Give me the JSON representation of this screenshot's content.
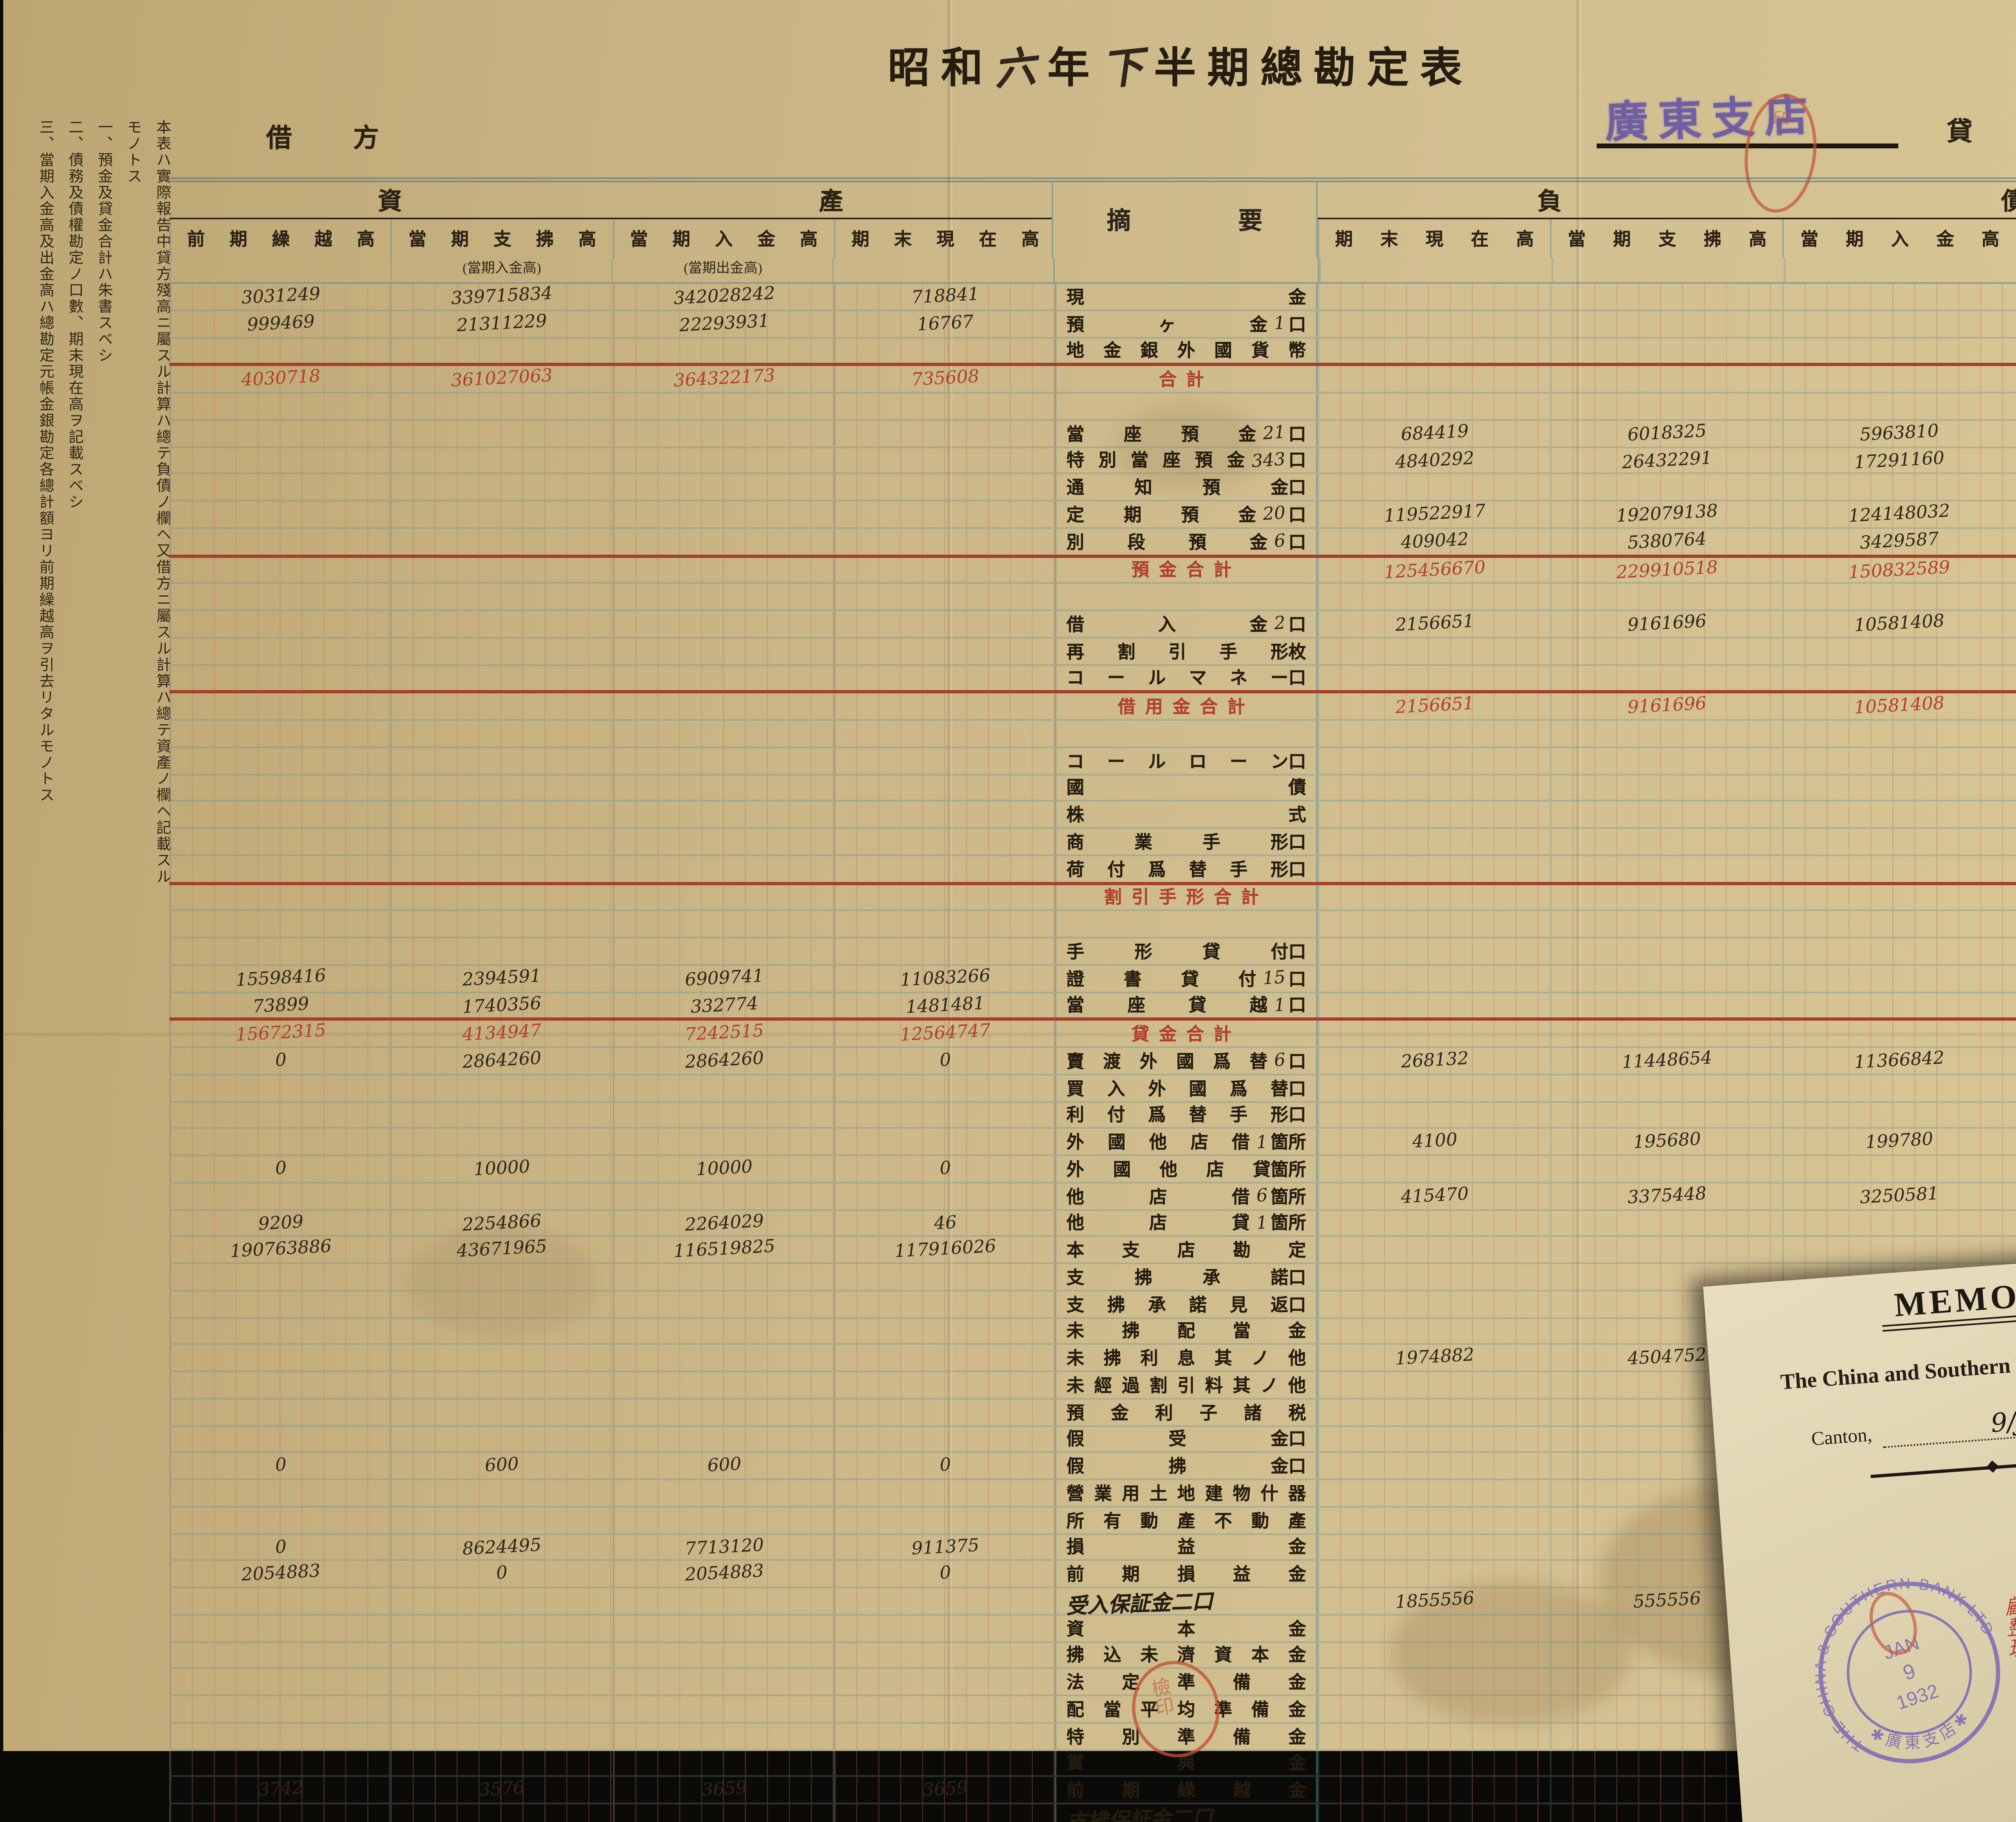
{
  "document": {
    "title": {
      "printed_prefix": "昭和",
      "hand_year": "六",
      "printed_mid": "年",
      "hand_period": "下",
      "printed_suffix": "半期總勘定表"
    },
    "branch_stamp": "廣東支店",
    "debit_header": "借方",
    "credit_header": "貸方",
    "notes": [
      "本表ハ實際報告中貸方殘高ニ屬スル計算ハ總テ負債ノ欄ヘ又借方ニ屬スル計算ハ總テ資產ノ欄ヘ記載スルモノトス",
      "一、預金及貸金合計ハ朱書スベシ",
      "二、債務及債權勘定ノ口數、期末現在高ヲ記載スベシ",
      "三、當期入金高及出金高ハ總勘定元帳金銀勘定各總計額ヨリ前期繰越高ヲ引去リタルモノトス"
    ],
    "table": {
      "left_group": "資產",
      "right_group": "負債",
      "middle_header": "摘要",
      "left_columns": [
        "前期繰越高",
        "當期支拂高",
        "當期入金高",
        "期末現在高"
      ],
      "left_subcolumns": [
        "",
        "(當期入金高)",
        "(當期出金高)",
        ""
      ],
      "right_columns": [
        "期末現在高",
        "當期支拂高",
        "當期入金高",
        "前期繰越高"
      ],
      "rows": [
        {
          "l": "現金",
          "t": "n",
          "L": [
            "3031249",
            "339715834",
            "342028242",
            "718841"
          ]
        },
        {
          "l": "預ヶ金",
          "c": "1",
          "u": "口",
          "t": "n",
          "L": [
            "999469",
            "21311229",
            "22293931",
            "16767"
          ]
        },
        {
          "l": "地金銀外國貨幣",
          "t": "n",
          "rl": true
        },
        {
          "l": "合計",
          "t": "r",
          "L": [
            "4030718",
            "361027063",
            "364322173",
            "735608"
          ]
        },
        {
          "t": "s"
        },
        {
          "l": "當座預金",
          "c": "21",
          "u": "口",
          "t": "n",
          "R": [
            "684419",
            "6018325",
            "5963810",
            "738934"
          ]
        },
        {
          "l": "特別當座預金",
          "c": "343",
          "u": "口",
          "t": "n",
          "R": [
            "4840292",
            "26432291",
            "17291160",
            "13981423"
          ]
        },
        {
          "l": "通知預金",
          "u": "口",
          "t": "n"
        },
        {
          "l": "定期預金",
          "c": "20",
          "u": "口",
          "t": "n",
          "R": [
            "119522917",
            "192079138",
            "124148032",
            "187454023"
          ]
        },
        {
          "l": "別段預金",
          "c": "6",
          "u": "口",
          "t": "n",
          "rl": true,
          "R": [
            "409042",
            "5380764",
            "3429587",
            "2360219"
          ]
        },
        {
          "l": "預金合計",
          "t": "r",
          "R": [
            "125456670",
            "229910518",
            "150832589",
            "204534599"
          ]
        },
        {
          "t": "s"
        },
        {
          "l": "借入金",
          "c": "2",
          "u": "口",
          "t": "n",
          "R": [
            "2156651",
            "9161696",
            "10581408",
            "736939"
          ]
        },
        {
          "l": "再割引手形",
          "u": "枚",
          "t": "n"
        },
        {
          "l": "コールマネー",
          "u": "口",
          "t": "n",
          "rl": true
        },
        {
          "l": "借用金合計",
          "t": "r",
          "R": [
            "2156651",
            "9161696",
            "10581408",
            "736939"
          ]
        },
        {
          "t": "s"
        },
        {
          "l": "コールローン",
          "u": "口",
          "t": "n"
        },
        {
          "l": "國債",
          "t": "n"
        },
        {
          "l": "株式",
          "t": "n"
        },
        {
          "l": "商業手形",
          "u": "口",
          "t": "n"
        },
        {
          "l": "荷付爲替手形",
          "u": "口",
          "t": "n",
          "rl": true
        },
        {
          "l": "割引手形合計",
          "t": "r"
        },
        {
          "t": "s"
        },
        {
          "l": "手形貸付",
          "u": "口",
          "t": "n"
        },
        {
          "l": "證書貸付",
          "c": "15",
          "u": "口",
          "t": "n",
          "L": [
            "15598416",
            "2394591",
            "6909741",
            "11083266"
          ]
        },
        {
          "l": "當座貸越",
          "c": "1",
          "u": "口",
          "t": "n",
          "rl": true,
          "L": [
            "73899",
            "1740356",
            "332774",
            "1481481"
          ]
        },
        {
          "l": "貸金合計",
          "t": "r",
          "L": [
            "15672315",
            "4134947",
            "7242515",
            "12564747"
          ]
        },
        {
          "l": "賣渡外國爲替",
          "c": "6",
          "u": "口",
          "t": "n",
          "L": [
            "0",
            "2864260",
            "2864260",
            "0"
          ],
          "R": [
            "268132",
            "11448654",
            "11366842",
            "349944"
          ]
        },
        {
          "l": "買入外國爲替",
          "u": "口",
          "t": "n"
        },
        {
          "l": "利付爲替手形",
          "u": "口",
          "t": "n"
        },
        {
          "l": "外國他店借",
          "c": "1",
          "u": "箇所",
          "t": "n",
          "R": [
            "4100",
            "195680",
            "199780",
            "0"
          ]
        },
        {
          "l": "外國他店貸",
          "u": "箇所",
          "t": "n",
          "L": [
            "0",
            "10000",
            "10000",
            "0"
          ]
        },
        {
          "l": "他店借",
          "c": "6",
          "u": "箇所",
          "t": "n",
          "R": [
            "415470",
            "3375448",
            "3250581",
            "540337"
          ]
        },
        {
          "l": "他店貸",
          "c": "1",
          "u": "箇所",
          "t": "n",
          "L": [
            "9209",
            "2254866",
            "2264029",
            "46"
          ]
        },
        {
          "l": "本支店勘定",
          "t": "n",
          "L": [
            "190763886",
            "43671965",
            "116519825",
            "117916026"
          ]
        },
        {
          "l": "支拂承諾",
          "u": "口",
          "t": "n"
        },
        {
          "l": "支拂承諾見返",
          "u": "口",
          "t": "n"
        },
        {
          "l": "未拂配當金",
          "t": "n"
        },
        {
          "l": "未拂利息其ノ他",
          "t": "n",
          "R": [
            "1974882",
            "4504752",
            "1974882",
            "4504752"
          ]
        },
        {
          "l": "未經過割引料其ノ他",
          "t": "n"
        },
        {
          "l": "預金利子諸税",
          "t": "n"
        },
        {
          "l": "假受金",
          "u": "口",
          "t": "n"
        },
        {
          "l": "假拂金",
          "u": "口",
          "t": "n",
          "L": [
            "0",
            "600",
            "600",
            "0"
          ]
        },
        {
          "l": "營業用土地建物什器",
          "t": "n"
        },
        {
          "l": "所有動產不動產",
          "t": "n"
        },
        {
          "l": "損益金",
          "t": "n",
          "L": [
            "0",
            "8624495",
            "7713120",
            "911375"
          ]
        },
        {
          "l": "前期損益金",
          "t": "n",
          "L": [
            "2054883",
            "0",
            "2054883",
            "0"
          ]
        },
        {
          "l": "受入保証金二口",
          "t": "h",
          "R": [
            "1855556",
            "555556",
            "",
            ""
          ]
        },
        {
          "l": "資本金",
          "t": "n"
        },
        {
          "l": "拂込未濟資本金",
          "t": "n"
        },
        {
          "l": "法定準備金",
          "t": "n"
        },
        {
          "l": "配當平均準備金",
          "t": "n"
        },
        {
          "l": "特別準備金",
          "t": "n"
        },
        {
          "l": "賞與金",
          "t": "n"
        },
        {
          "l": "前期繰越金",
          "t": "n",
          "L": [
            "3742",
            "3576",
            "3659",
            "3659"
          ]
        },
        {
          "l": "支拂保証金二口",
          "t": "h"
        },
        {
          "l": "總計",
          "t": "t",
          "L": [
            "212534753",
            "422591772",
            "502995064",
            "132131461"
          ],
          "R": [
            "132131461",
            "259152304",
            "",
            ""
          ]
        }
      ]
    },
    "bottom_seal_chars": "檢印",
    "top_seal_chars": "印",
    "memo": {
      "heading": "MEMO.",
      "bank": "The China and Southern Bank, Limited.",
      "place": "Canton,",
      "date_hand": "9/Jan",
      "year_printed": "19",
      "year_hand": "32",
      "note_columns_approx": [
        "為替中止に",
        "受入支拂係勘定ノ期末係",
        "勘定末現在高ト相違ノ分ハ",
        "純ク統ケ仕切ノ整理ノ相違",
        "整理ハ半期末迄ニ相済可申候",
        "タルモノニ相成居候也"
      ],
      "red_note_columns_approx": [
        "金額ハ差異ノ有無如何ニヨリテ相違",
        "ニ依リテ相成"
      ],
      "red_side_note_approx": "顧整理",
      "stamp": {
        "ring_top": "THE CHINA & SOUTHERN BANK LTD",
        "ring_bottom": "✱ 廣 東 支 店 ✱",
        "center_month": "JAN",
        "center_day": "9",
        "center_year": "1932"
      }
    },
    "colors": {
      "accent_red": "#a3402a",
      "red_ink": "#b0402c",
      "ink": "#2e261c",
      "stamp_purple": "#6858a5",
      "memo_stamp_violet": "#7e6cb5",
      "paper": "#cdb988",
      "memo_paper": "#e3d9b8",
      "line_blue": "#7fa3ab",
      "line_red": "#c6705c"
    }
  }
}
